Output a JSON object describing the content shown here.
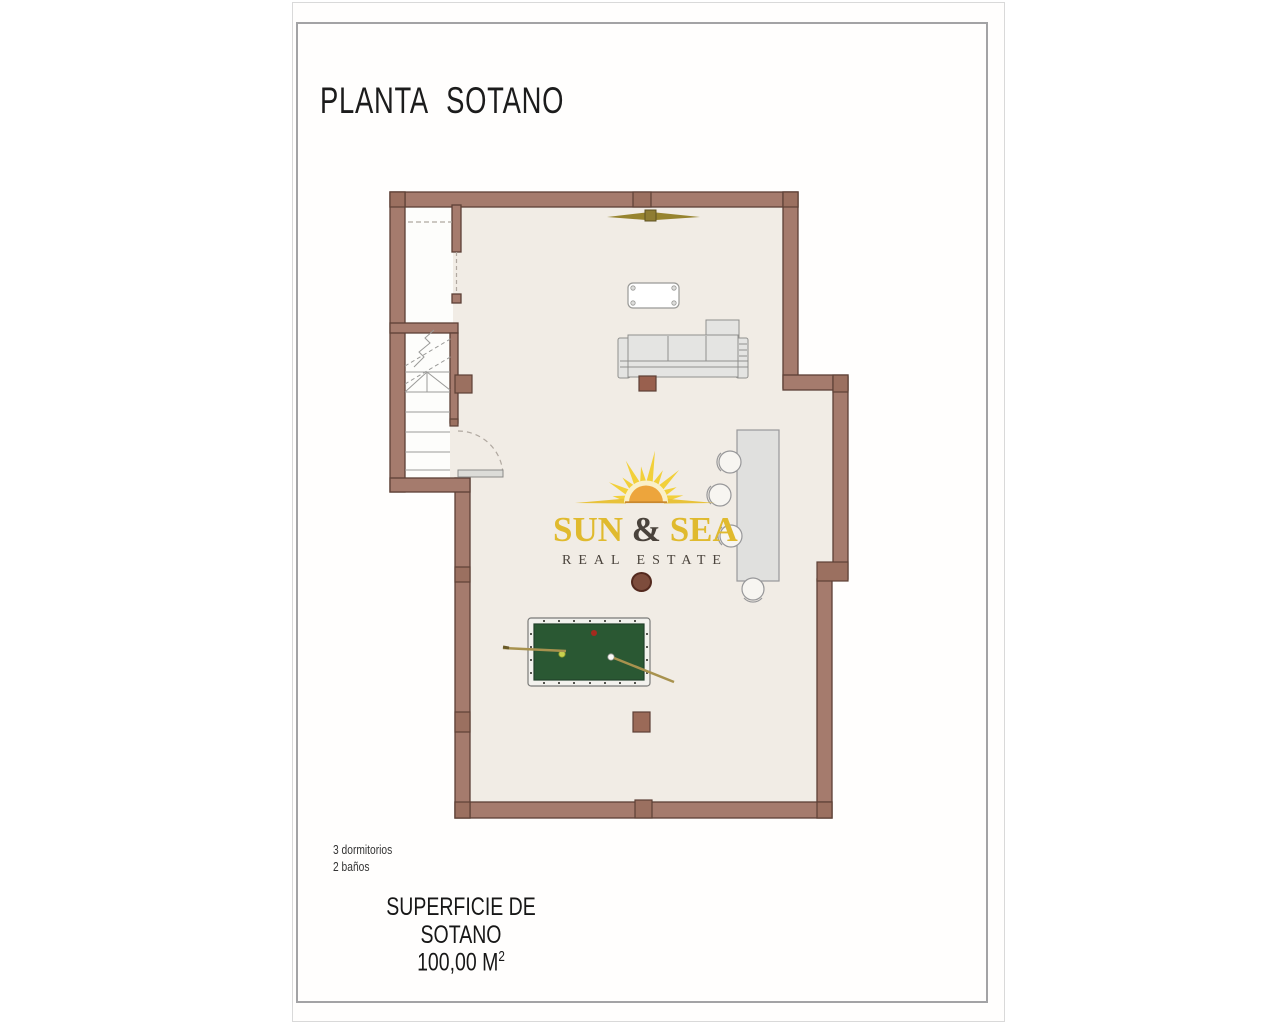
{
  "page": {
    "title": "PLANTA SOTANO",
    "footer": {
      "bedrooms": "3 dormitorios",
      "bathrooms": "2 baños",
      "area_label": "SUPERFICIE DE SOTANO",
      "area_value": "100,00 M",
      "area_sup": "2"
    }
  },
  "logo": {
    "word_sun": "SUN",
    "word_amp": " & ",
    "word_sea": "SEA",
    "subtitle": "REAL ESTATE"
  },
  "colors": {
    "wall_fill": "#a57b6d",
    "wall_outline": "#5d4036",
    "column_fill": "#9b7060",
    "floor_fill": "#f1ece5",
    "room_white": "#fdfdfb",
    "pool_felt": "#2a5833",
    "furniture_gray": "#e4e4e2",
    "logo_gold": "#e0ba2e",
    "logo_dark": "#4a433c",
    "frame_border": "#a3a3a5"
  }
}
